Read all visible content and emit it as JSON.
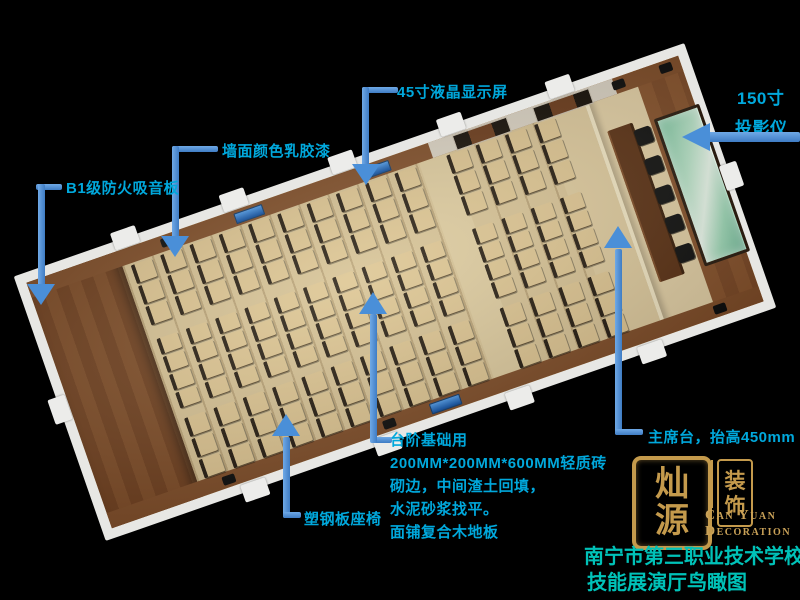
{
  "callouts": {
    "lcd": {
      "label": "45寸液晶显示屏"
    },
    "projector": {
      "line1": "150寸",
      "line2": "投影仪"
    },
    "paint": {
      "label": "墙面颜色乳胶漆"
    },
    "acoustic": {
      "label": "B1级防火吸音板"
    },
    "steps": {
      "lines": [
        "台阶基础用",
        "200MM*200MM*600MM轻质砖",
        "砌边，中间渣土回填，",
        "水泥砂浆找平。",
        "面铺复合木地板"
      ]
    },
    "seat": {
      "label": "塑钢板座椅"
    },
    "stage": {
      "label": "主席台，抬高450mm"
    }
  },
  "logo": {
    "seal_main_chars": [
      "灿",
      "源"
    ],
    "seal_side_chars": [
      "装",
      "饰"
    ],
    "english_line1": "Can Yuan",
    "english_line2": "Decoration"
  },
  "title": {
    "line1": "南宁市第三职业技术学校",
    "line2": "技能展演厅鸟瞰图"
  },
  "colors": {
    "label_text": "#00a8dc",
    "title_text": "#00c2b8",
    "leader": "#4a8fd8",
    "logo_gold": "#c49a4c",
    "screen_green": "#8ecfa8",
    "floor_wood": "#d5c094",
    "wall_wood": "#7e4c28"
  },
  "scene": {
    "seat_rows_rear": 10,
    "seat_rows_front": 4,
    "banks": [
      3,
      4,
      3
    ],
    "stage_chairs": 5
  }
}
